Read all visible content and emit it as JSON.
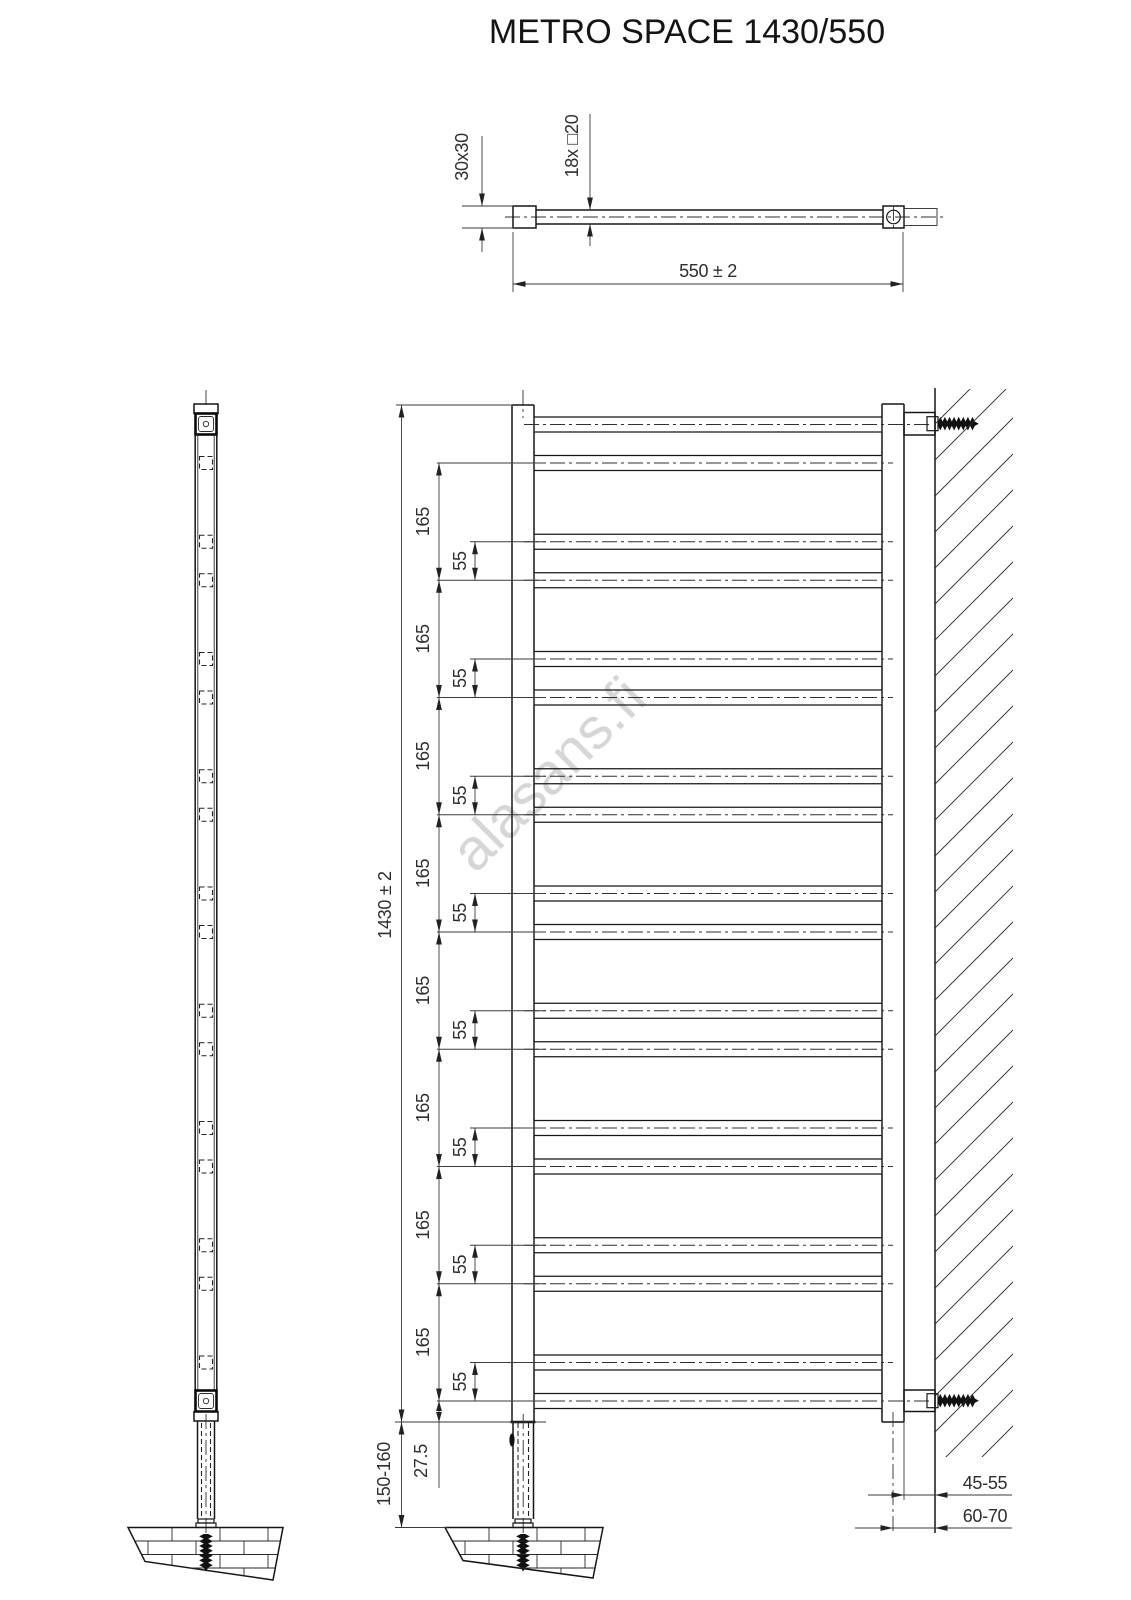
{
  "title": "METRO SPACE 1430/550",
  "watermark": "alasans.fi",
  "top_view": {
    "profile": "30x30",
    "rungs": "18x □20",
    "width": "550 ± 2"
  },
  "front_view": {
    "height": "1430 ± 2",
    "pitch_labels": [
      "165",
      "165",
      "165",
      "165",
      "165",
      "165",
      "165",
      "165"
    ],
    "pair_labels": [
      "55",
      "55",
      "55",
      "55",
      "55",
      "55",
      "55",
      "55"
    ],
    "bottom_offset": "27.5",
    "leg_height": "150-160",
    "wall_distance_edge": "45-55",
    "wall_distance_center": "60-70"
  }
}
